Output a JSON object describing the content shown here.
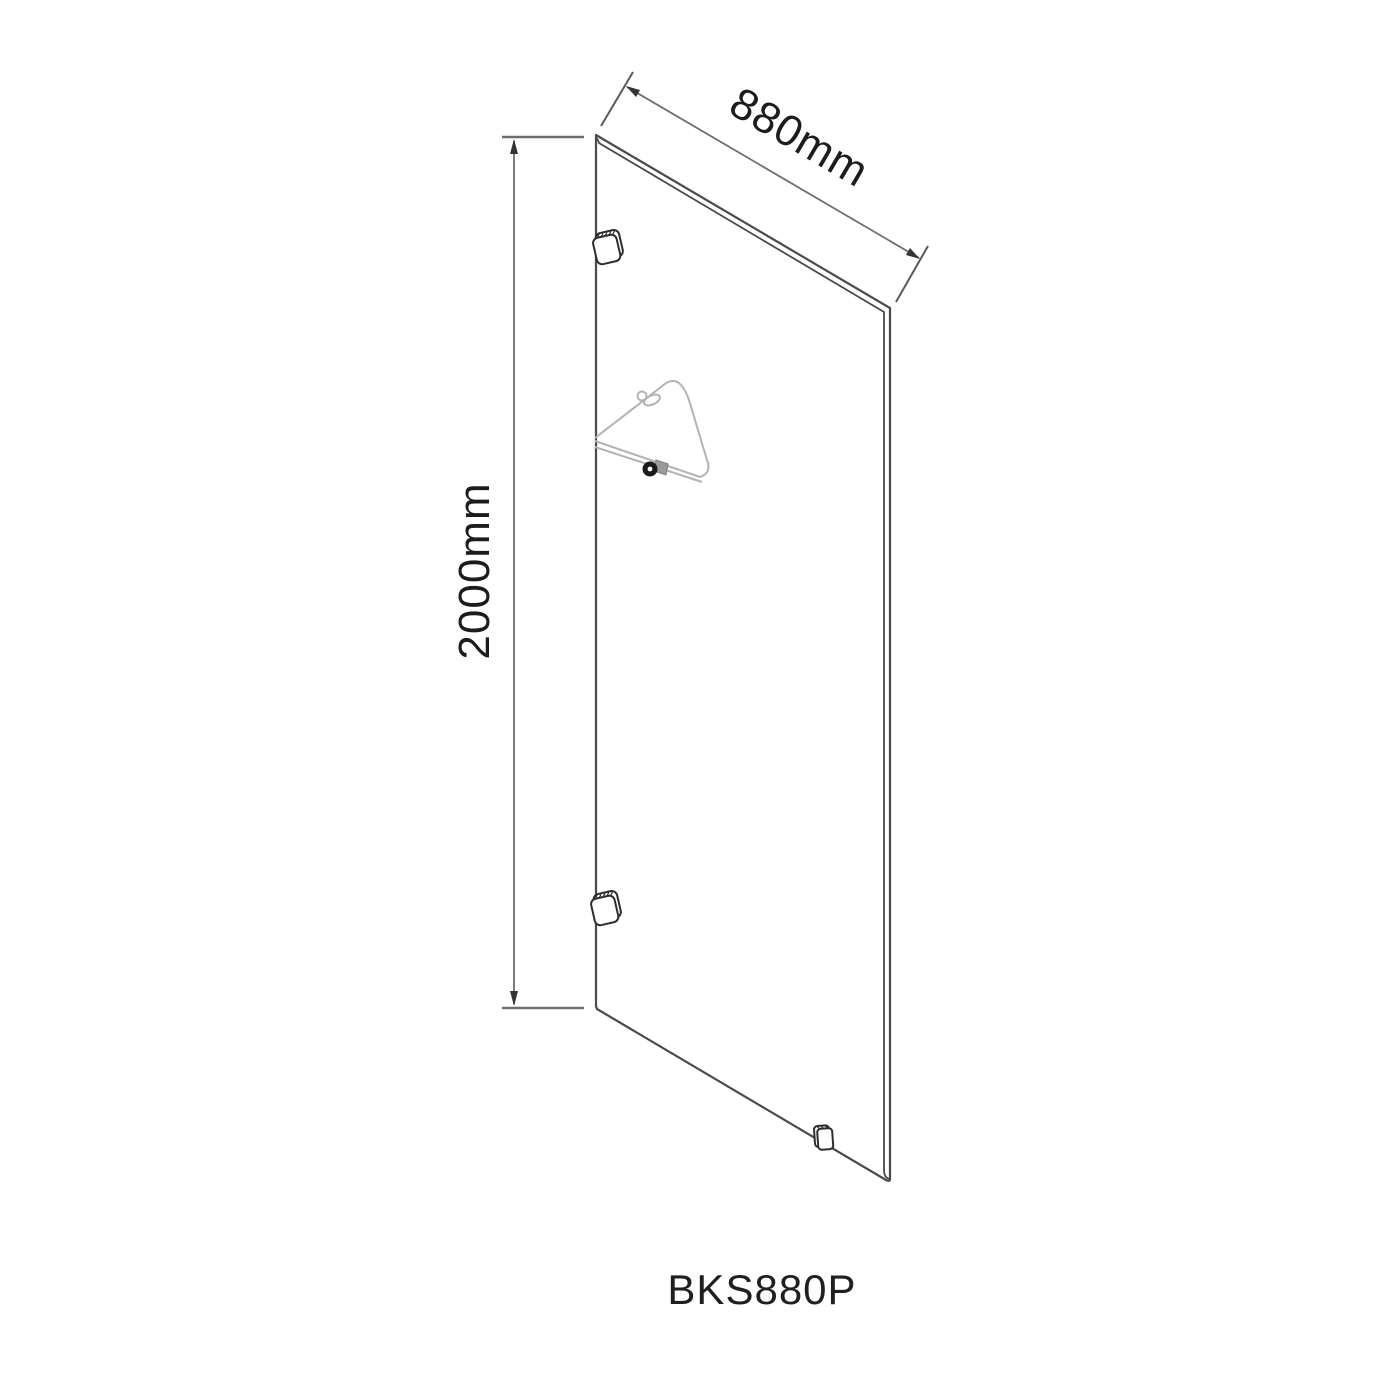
{
  "diagram": {
    "product_code": "BKS880P",
    "dimensions": {
      "width": "880mm",
      "height": "2000mm"
    }
  },
  "icons": {
    "glass_panel": "glass-panel-outline",
    "wall_clamps": "wall-clamp-icon",
    "floor_clamp": "floor-clamp-icon",
    "support_arm": "support-arm-icon",
    "dimension_arrows": "dimension-arrow-icon"
  },
  "colors": {
    "background": "#ffffff",
    "panel_outline": "#4a4a4a",
    "dimension_line": "#6e6e6e",
    "label_text": "#1c1c1c",
    "support_arm": "#b3b3b3",
    "clamp_outline": "#2e2e2e"
  }
}
